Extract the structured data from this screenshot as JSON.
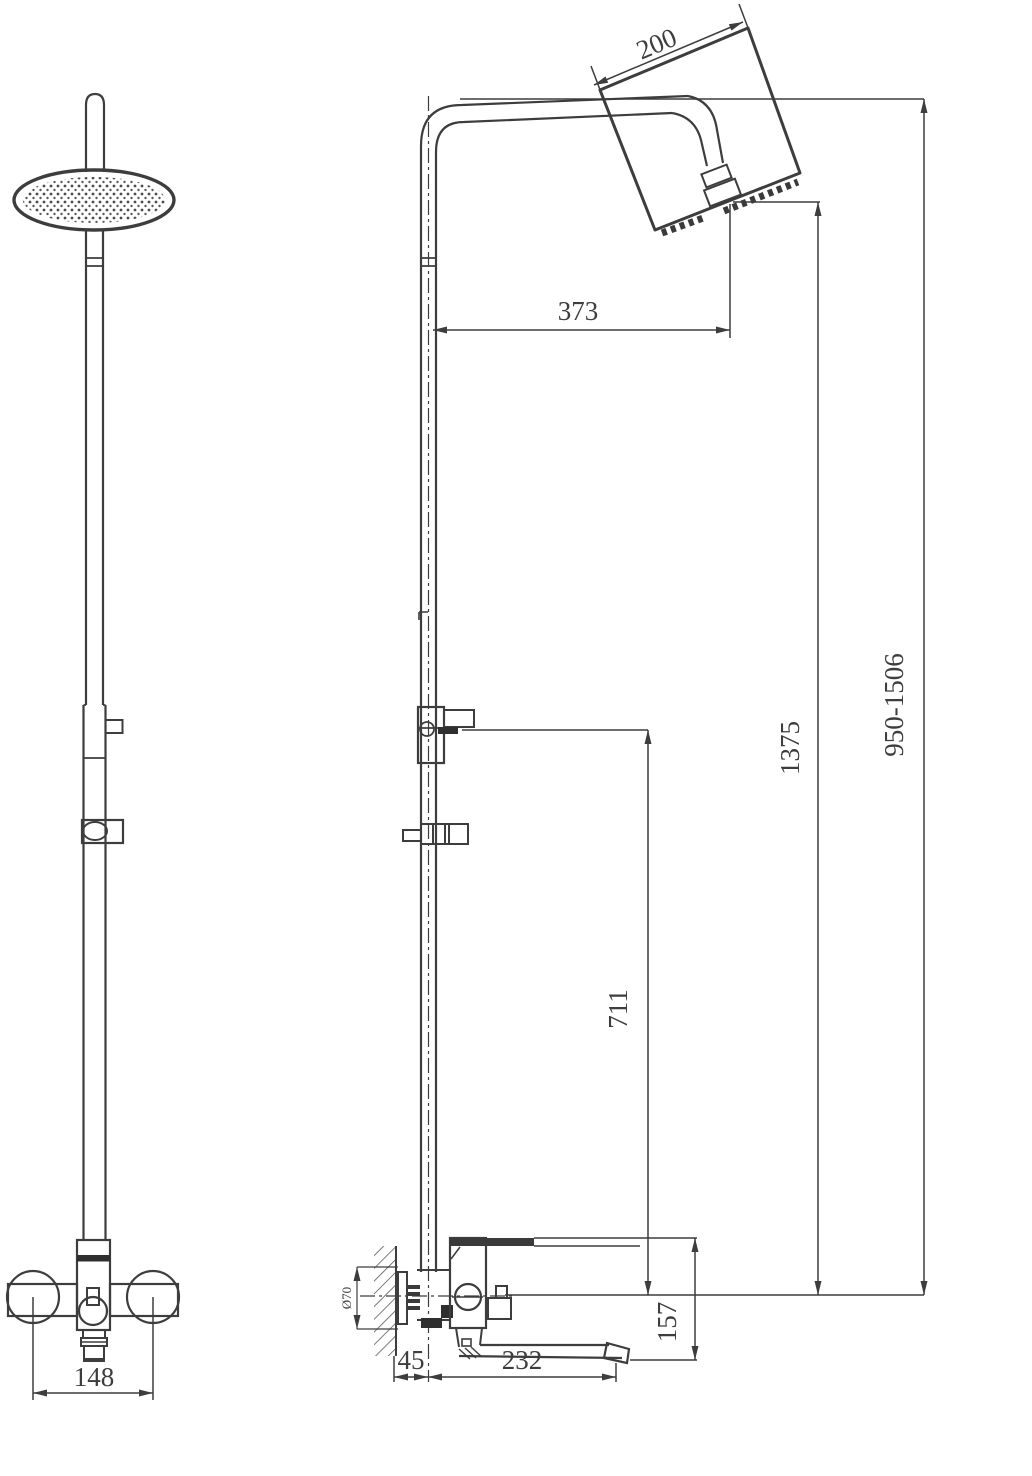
{
  "drawing": {
    "front_view": {
      "mount_centers_width": "148"
    },
    "side_view": {
      "head_width": "200",
      "head_reach": "373",
      "height_to_head": "1375",
      "total_height_range": "950-1506",
      "bracket_height": "711",
      "spout_section_height": "157",
      "wall_offset": "45",
      "spout_length": "232",
      "escutcheon_diameter": "Ø70"
    },
    "colors": {
      "line": "#3d3d3d",
      "dark_fill": "#2f2f2f",
      "background": "#ffffff"
    }
  }
}
